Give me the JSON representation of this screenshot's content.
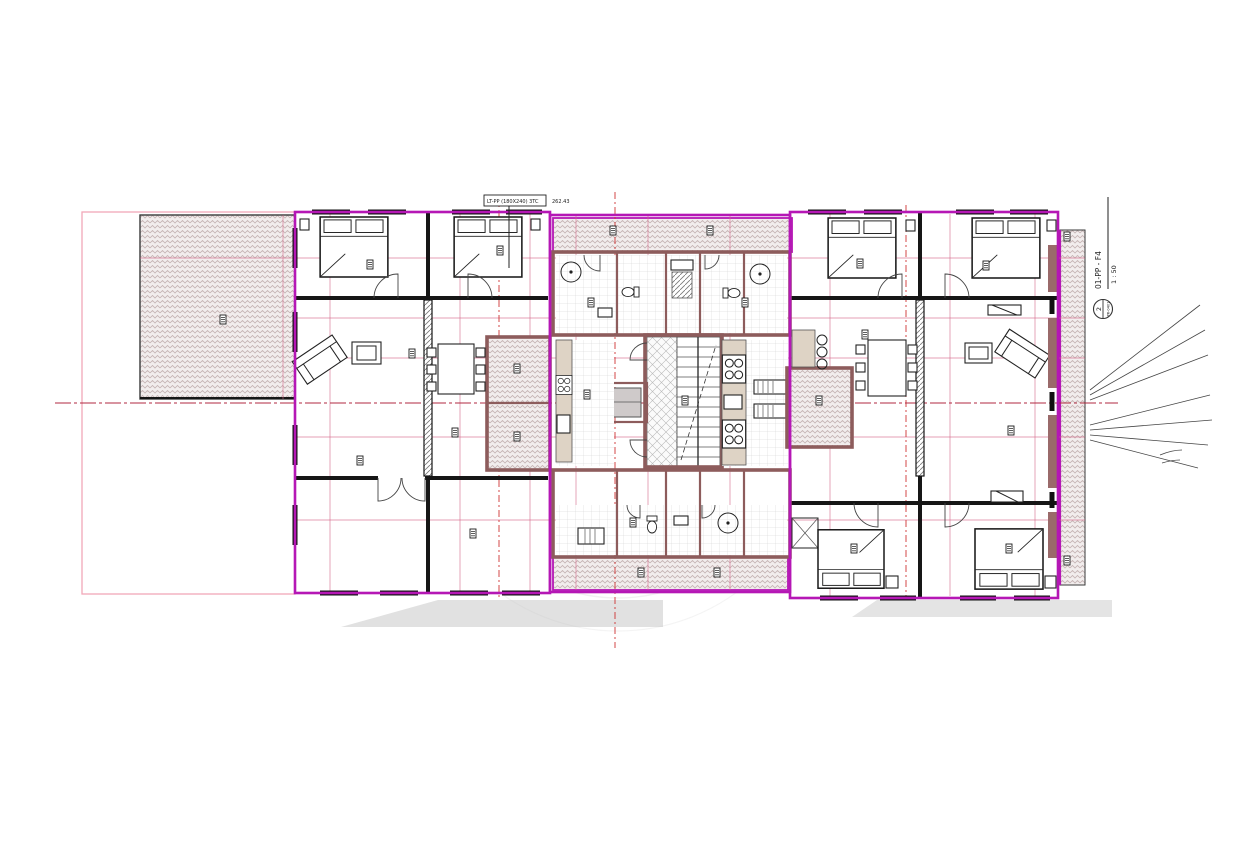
{
  "title_block": {
    "label": "LT-PP (180X240) 3TC",
    "elevation": "262.43"
  },
  "view_marker": {
    "view_name": "01-PP - F4",
    "scale": "1 : 50",
    "detail_number": "2",
    "sheet_ref": "PR-0401"
  },
  "colors": {
    "boundary_magenta": "#b517b5",
    "grid_pink": "#d4688a",
    "centerline_red": "#cf3434",
    "wall_black": "#161616",
    "wet_wall_maroon": "#8d5c5c",
    "counter_beige": "#ded3c5",
    "hatch_tone": "#c4b2b2",
    "shadow_gray": "#e1e1e1",
    "elevator_gray": "#cfcaca"
  }
}
